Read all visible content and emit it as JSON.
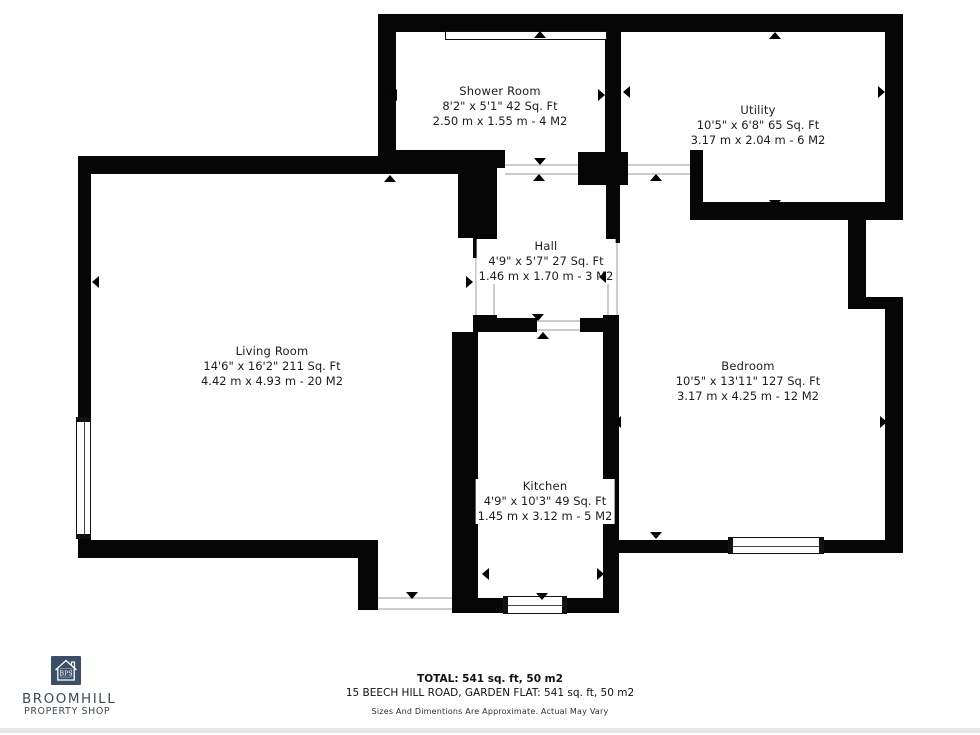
{
  "colors": {
    "wall": "#060606",
    "door_line": "#cccccc",
    "logo_navy": "#3b4f68",
    "logo_text": "#3f4a55"
  },
  "rooms": [
    {
      "id": "shower",
      "name": "Shower Room",
      "imperial": "8'2\" x 5'1\" 42 Sq. Ft",
      "metric": "2.50 m x 1.55 m - 4 M2"
    },
    {
      "id": "utility",
      "name": "Utility",
      "imperial": "10'5\" x 6'8\" 65 Sq. Ft",
      "metric": "3.17 m x 2.04 m - 6 M2"
    },
    {
      "id": "hall",
      "name": "Hall",
      "imperial": "4'9\" x 5'7\" 27 Sq. Ft",
      "metric": "1.46 m x 1.70 m - 3 M2"
    },
    {
      "id": "living",
      "name": "Living Room",
      "imperial": "14'6\" x 16'2\" 211 Sq. Ft",
      "metric": "4.42 m x 4.93 m - 20 M2"
    },
    {
      "id": "bedroom",
      "name": "Bedroom",
      "imperial": "10'5\" x 13'11\" 127 Sq. Ft",
      "metric": "3.17 m x 4.25 m - 12 M2"
    },
    {
      "id": "kitchen",
      "name": "Kitchen",
      "imperial": "4'9\" x 10'3\" 49 Sq. Ft",
      "metric": "1.45 m x 3.12 m - 5 M2"
    }
  ],
  "footer": {
    "total": "TOTAL: 541 sq. ft, 50 m2",
    "address": "15 BEECH HILL ROAD, GARDEN FLAT: 541 sq. ft, 50 m2",
    "disclaimer": "Sizes And Dimentions Are Approximate. Actual May Vary"
  },
  "logo": {
    "initials": "BPS",
    "line1": "BROOMHILL",
    "line2": "PROPERTY SHOP"
  }
}
